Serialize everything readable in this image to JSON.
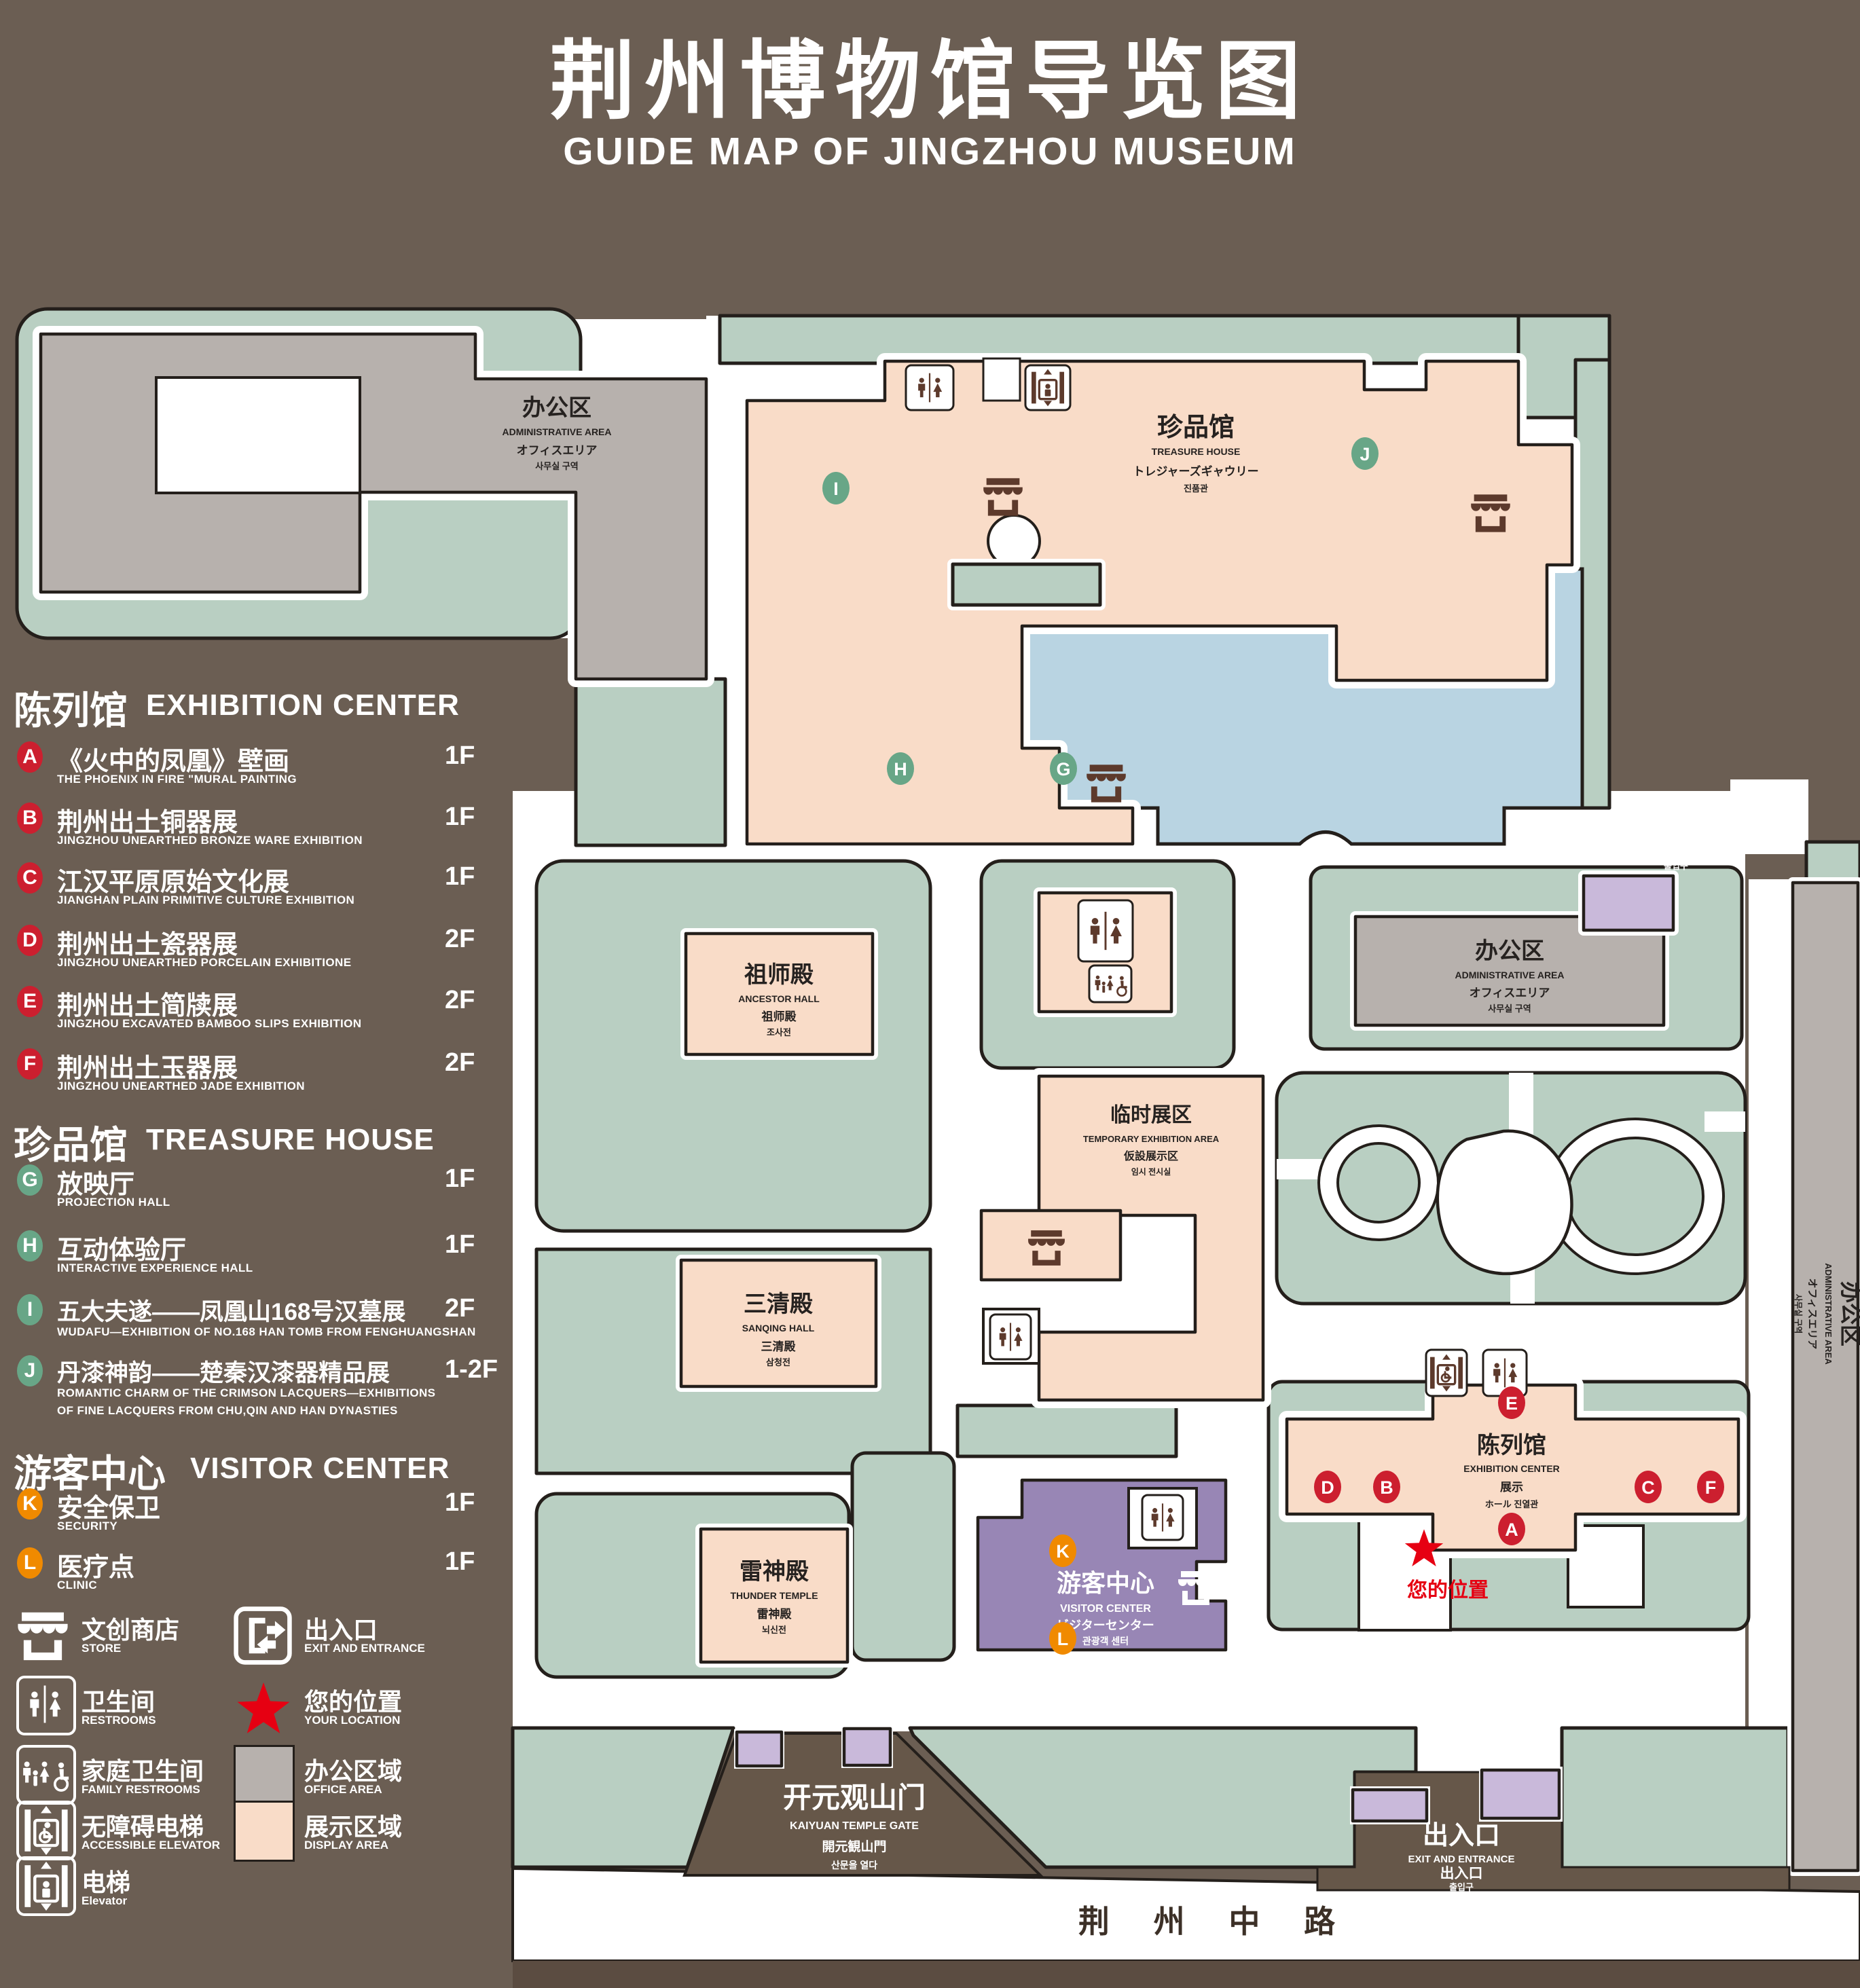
{
  "title": {
    "zh": "荆州博物馆导览图",
    "en": "GUIDE MAP OF JINGZHOU MUSEUM"
  },
  "colors": {
    "background": "#6b5e53",
    "display_area": "#f9dcc8",
    "office_area": "#b7b1ad",
    "lawn": "#b9cfc2",
    "lake": "#b9d4e2",
    "visitor_center": "#9886b5",
    "gate_fill": "#c9b9da",
    "marker_red": "#cc1f2f",
    "marker_green": "#68a687",
    "marker_orange": "#f08a00",
    "icon_brown": "#5d3a2c",
    "location_red": "#e60012"
  },
  "legend": {
    "sections": [
      {
        "zh": "陈列馆",
        "en": "EXHIBITION CENTER",
        "items": [
          {
            "letter": "A",
            "zh": "《火中的凤凰》壁画",
            "en": "THE PHOENIX IN FIRE \"MURAL PAINTING",
            "floor": "1F"
          },
          {
            "letter": "B",
            "zh": "荆州出土铜器展",
            "en": "JINGZHOU UNEARTHED BRONZE WARE EXHIBITION",
            "floor": "1F"
          },
          {
            "letter": "C",
            "zh": "江汉平原原始文化展",
            "en": "JIANGHAN PLAIN PRIMITIVE CULTURE EXHIBITION",
            "floor": "1F"
          },
          {
            "letter": "D",
            "zh": "荆州出土瓷器展",
            "en": "JINGZHOU UNEARTHED PORCELAIN EXHIBITIONE",
            "floor": "2F"
          },
          {
            "letter": "E",
            "zh": "荆州出土简牍展",
            "en": "JINGZHOU EXCAVATED BAMBOO SLIPS EXHIBITION",
            "floor": "2F"
          },
          {
            "letter": "F",
            "zh": "荆州出土玉器展",
            "en": "JINGZHOU UNEARTHED JADE EXHIBITION",
            "floor": "2F"
          }
        ]
      },
      {
        "zh": "珍品馆",
        "en": "TREASURE HOUSE",
        "items": [
          {
            "letter": "G",
            "zh": "放映厅",
            "en": "PROJECTION HALL",
            "floor": "1F"
          },
          {
            "letter": "H",
            "zh": "互动体验厅",
            "en": "INTERACTIVE EXPERIENCE HALL",
            "floor": "1F"
          },
          {
            "letter": "I",
            "zh": "五大夫遂——凤凰山168号汉墓展",
            "en": "WUDAFU—EXHIBITION OF NO.168 HAN TOMB FROM FENGHUANGSHAN",
            "floor": "2F"
          },
          {
            "letter": "J",
            "zh": "丹漆神韵——楚秦汉漆器精品展",
            "en": "ROMANTIC CHARM OF THE CRIMSON LACQUERS—EXHIBITIONS",
            "en2": "OF FINE LACQUERS FROM CHU,QIN AND HAN DYNASTIES",
            "floor": "1-2F"
          }
        ]
      },
      {
        "zh": "游客中心",
        "en": "VISITOR CENTER",
        "items": [
          {
            "letter": "K",
            "zh": "安全保卫",
            "en": "SECURITY",
            "floor": "1F"
          },
          {
            "letter": "L",
            "zh": "医疗点",
            "en": "CLINIC",
            "floor": "1F"
          }
        ]
      }
    ],
    "symbols": [
      {
        "zh": "文创商店",
        "en": "STORE"
      },
      {
        "zh": "出入口",
        "en": "EXIT AND ENTRANCE"
      },
      {
        "zh": "卫生间",
        "en": "RESTROOMS"
      },
      {
        "zh": "您的位置",
        "en": "YOUR LOCATION"
      },
      {
        "zh": "家庭卫生间",
        "en": "FAMILY RESTROOMS"
      },
      {
        "zh": "办公区域",
        "en": "OFFICE AREA"
      },
      {
        "zh": "无障碍电梯",
        "en": "ACCESSIBLE ELEVATOR"
      },
      {
        "zh": "展示区域",
        "en": "DISPLAY AREA"
      },
      {
        "zh": "电梯",
        "en": "Elevator"
      }
    ]
  },
  "map": {
    "admin": {
      "zh": "办公区",
      "en": "ADMINISTRATIVE AREA",
      "jp": "オフィスエリア",
      "kr": "사무실 구역"
    },
    "treasure": {
      "zh": "珍品馆",
      "en": "TREASURE HOUSE",
      "jp": "トレジャーズギャウリー",
      "kr": "진품관"
    },
    "ancestor": {
      "zh": "祖师殿",
      "en": "ANCESTOR HALL",
      "jp": "祖师殿",
      "kr": "조사전"
    },
    "sanqing": {
      "zh": "三清殿",
      "en": "SANQING HALL",
      "jp": "三清殿",
      "kr": "삼청전"
    },
    "thunder": {
      "zh": "雷神殿",
      "en": "THUNDER TEMPLE",
      "jp": "雷神殿",
      "kr": "뇌신전"
    },
    "temporary": {
      "zh": "临时展区",
      "en": "TEMPORARY EXHIBITION AREA",
      "jp": "仮設展示区",
      "kr": "임시 전시실"
    },
    "exhibition": {
      "zh": "陈列馆",
      "en": "EXHIBITION CENTER",
      "jp": "展示",
      "kr": "ホール 진열관"
    },
    "visitor": {
      "zh": "游客中心",
      "en": "VISITOR CENTER",
      "jp": "ビジターセンター",
      "kr": "관광객 센터"
    },
    "gate": {
      "zh": "开元观山门",
      "en": "KAIYUAN TEMPLE GATE",
      "jp": "開元観山門",
      "kr": "산문을 열다"
    },
    "exit": {
      "zh": "出入口",
      "en": "EXIT AND ENTRANCE",
      "zh2": "出入口",
      "kr": "출입구"
    },
    "road": "荆 州 中 路",
    "location": "您的位置",
    "markers": {
      "a": "A",
      "b": "B",
      "c": "C",
      "d": "D",
      "e": "E",
      "f": "F",
      "g": "G",
      "h": "H",
      "i": "I",
      "j": "J",
      "k": "K",
      "l": "L"
    }
  }
}
